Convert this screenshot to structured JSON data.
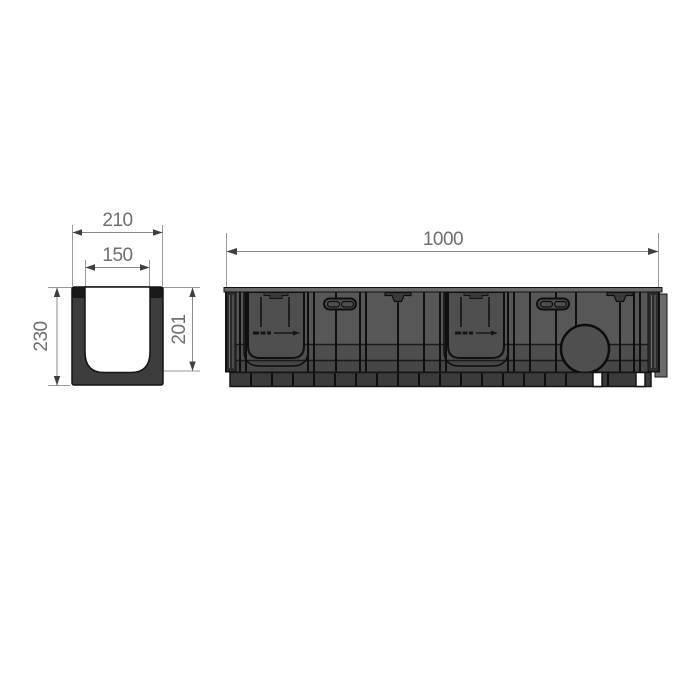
{
  "page": {
    "background": "#ffffff",
    "description": "technical drawing of a plastic drainage channel: U cross-section view and side elevation view with dimensions"
  },
  "drawing": {
    "views": {
      "cross_section": {
        "name": "channel-cross-section",
        "dims": {
          "outer_width": "210",
          "inner_width": "150",
          "outer_height": "230",
          "inner_depth": "201"
        }
      },
      "side_view": {
        "name": "channel-side-elevation",
        "dims": {
          "length": "1000"
        }
      }
    },
    "colors": {
      "section_body": "#3c3c3c",
      "section_cap": "#191919",
      "side_body": "#575757",
      "side_band": "#4e4e4e",
      "side_feet": "#3b3b3b",
      "outline": "#141414",
      "dimension_line": "#8a8a8a",
      "dimension_text": "#6f6f6f",
      "background": "#ffffff"
    }
  }
}
